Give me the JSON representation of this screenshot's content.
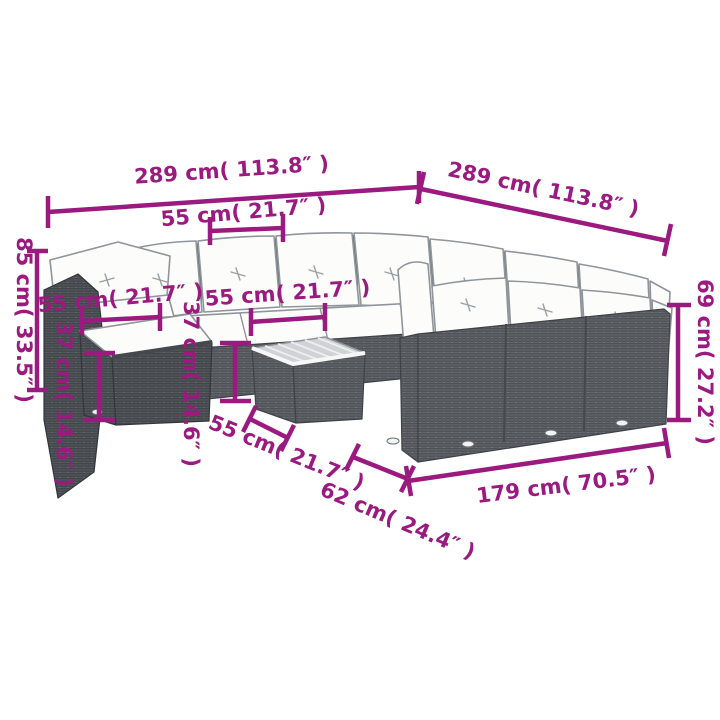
{
  "meta": {
    "description": "Product dimension diagram of a grey poly-rattan garden lounge set (U-shaped sectional sofa with cushions, footstool and coffee table) annotated with magenta measurement lines",
    "canvas": {
      "width": 720,
      "height": 720
    },
    "background": "#ffffff"
  },
  "style": {
    "dimension_color": "#9a1a80",
    "line_art_color": "#8f959a",
    "wicker_mid": "#62666a",
    "wicker_dark": "#53575a",
    "cushion_color": "#fcfcfa",
    "table_top_color": "#cfd3d6"
  },
  "dimensions": {
    "top_width": "289 cm( 113.8″ )",
    "back_depth": "289 cm( 113.8″ )",
    "seat_width_back": "55 cm( 21.7″ )",
    "total_height": "85 cm( 33.5″ )",
    "seat_width_corner": "55 cm( 21.7″ )",
    "seat_height": "37 cm( 14.6″ )",
    "seat_width_mid": "55 cm( 21.7″ )",
    "table_height": "37 cm( 14.6″ )",
    "table_width": "55 cm( 21.7″ )",
    "seat_depth": "62 cm( 24.4″ )",
    "right_row_length": "179 cm( 70.5″ )",
    "backrest_height": "69 cm( 27.2″ )"
  }
}
